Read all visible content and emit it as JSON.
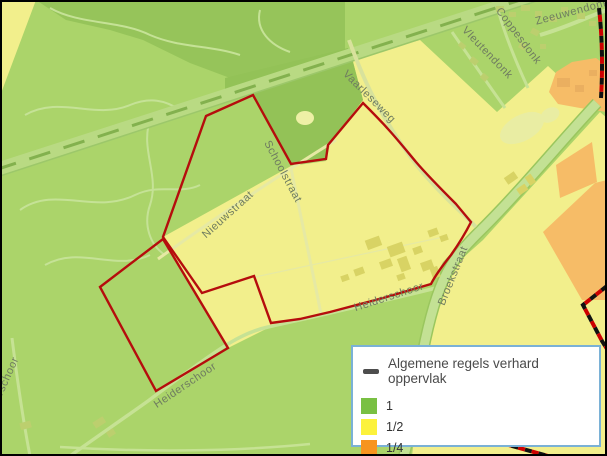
{
  "legend": {
    "title": "Algemene regels verhard oppervlak",
    "items": [
      {
        "label": "1",
        "color": "#79c043"
      },
      {
        "label": "1/2",
        "color": "#fcf23c"
      },
      {
        "label": "1/4",
        "color": "#f7941e"
      }
    ]
  },
  "map": {
    "street_labels": [
      {
        "text": "Vaarleseweg"
      },
      {
        "text": "Schoolstraat"
      },
      {
        "text": "Nieuwstraat"
      },
      {
        "text": "Heiderschoor"
      },
      {
        "text": "Broekstraat"
      },
      {
        "text": "Heiderschoor"
      },
      {
        "text": "Heiderschoor"
      },
      {
        "text": "Coppesdonk"
      },
      {
        "text": "Vleutendonk"
      },
      {
        "text": "Zeeuwendonk"
      }
    ],
    "colors": {
      "zone_full_green": "#abd46a",
      "zone_half_yellow": "#f2ef8c",
      "zone_quarter_orange": "#f6bc67",
      "forest_green": "#96c45a",
      "road_band_green": "#c3e194",
      "parcel_outline_red": "#b50d0d",
      "municipal_boundary_black": "#111111",
      "municipal_boundary_red": "#cc0000",
      "legend_border_blue": "#7ab1d6"
    }
  }
}
